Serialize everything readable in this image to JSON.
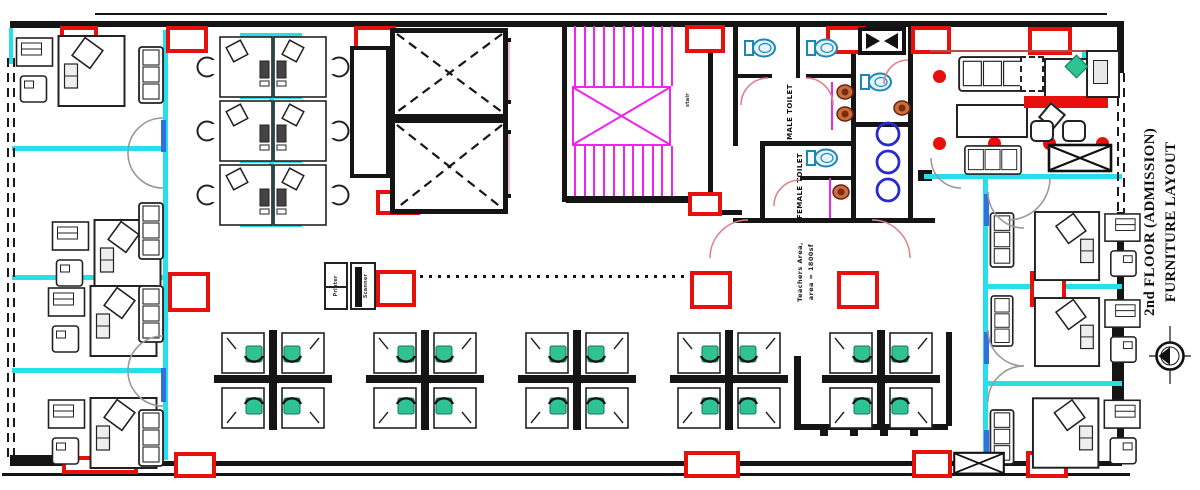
{
  "title": {
    "line1": "2nd FLOOR (ADMISSION)",
    "line2": "FURNITURE LAYOUT"
  },
  "rooms": {
    "male_toilet": "MALE TOILET",
    "female_toilet": "FEMALE TOILET"
  },
  "annotations": {
    "area_line1": "Teachers Area,",
    "area_line2": "area = 1800sf",
    "stair": "stair"
  },
  "equipment": {
    "printer": "Printer",
    "scanner": "Scanner"
  },
  "colors": {
    "column_red": "#e8100c",
    "partition_cyan": "#27dfe8",
    "stair_magenta": "#ee25ee",
    "chair_teal": "#2fc394",
    "elevator_door_pink": "#f2b9c7",
    "wall_black": "#151515",
    "door_arc_gray": "#9a9a9a",
    "basin_blue": "#2a2ad0",
    "sink_brown": "#a34222",
    "reception_accent_red": "#e8100c"
  }
}
